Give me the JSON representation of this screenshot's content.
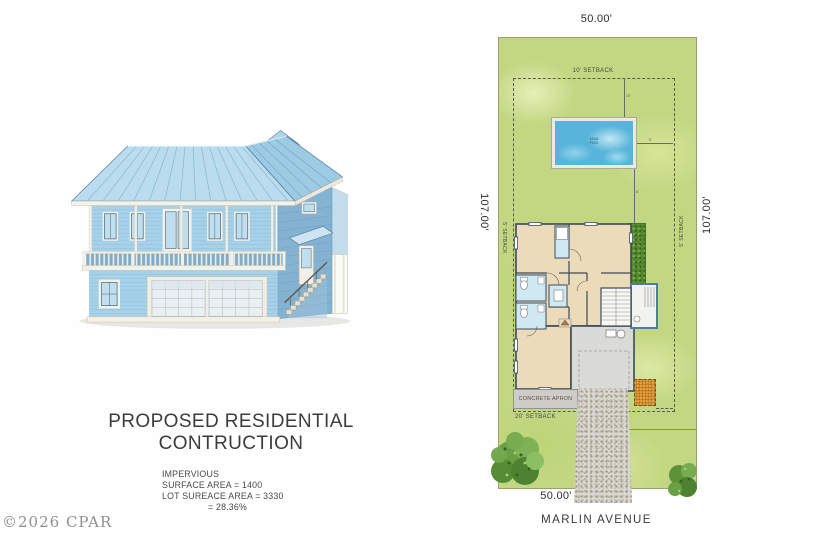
{
  "left_panel": {
    "title": "PROPOSED RESIDENTIAL CONTRUCTION",
    "stats": {
      "heading": "IMPERVIOUS",
      "surface": "SURFACE AREA = 1400",
      "lot": "LOT SUREACE AREA = 3330",
      "ratio": "= 28.36%"
    },
    "watermark": "©2026 CPAR"
  },
  "site_plan": {
    "street_name": "MARLIN AVENUE",
    "frontage_top": "50.00'",
    "frontage_bottom": "50.00'",
    "depth_left": "107.00'",
    "depth_right": "107.00'",
    "setbacks": {
      "rear": "10' SETBACK",
      "front": "20' SETBACK",
      "left": "5' SETBACK",
      "right": "5' SETBACK"
    },
    "apron_label": "CONCRETE APRON",
    "pool": {
      "label_line1": "12x24",
      "label_line2": "POOL"
    },
    "small_dims": {
      "rear_to_pool": "10'",
      "pool_to_side": "5'",
      "pool_to_house": "8'"
    },
    "colors": {
      "grass": "#c3d783",
      "pool_water": "#58b4da",
      "roof": "#badcee",
      "siding": "#a6d1e8",
      "floorplan_floor": "#ecdbb8",
      "bath_blue": "#cfe9f2",
      "garage_slab": "#dadad6",
      "gravel": "#d8d5cd",
      "sand_pad": "#e2a13e",
      "hedge": "#55882f"
    }
  }
}
